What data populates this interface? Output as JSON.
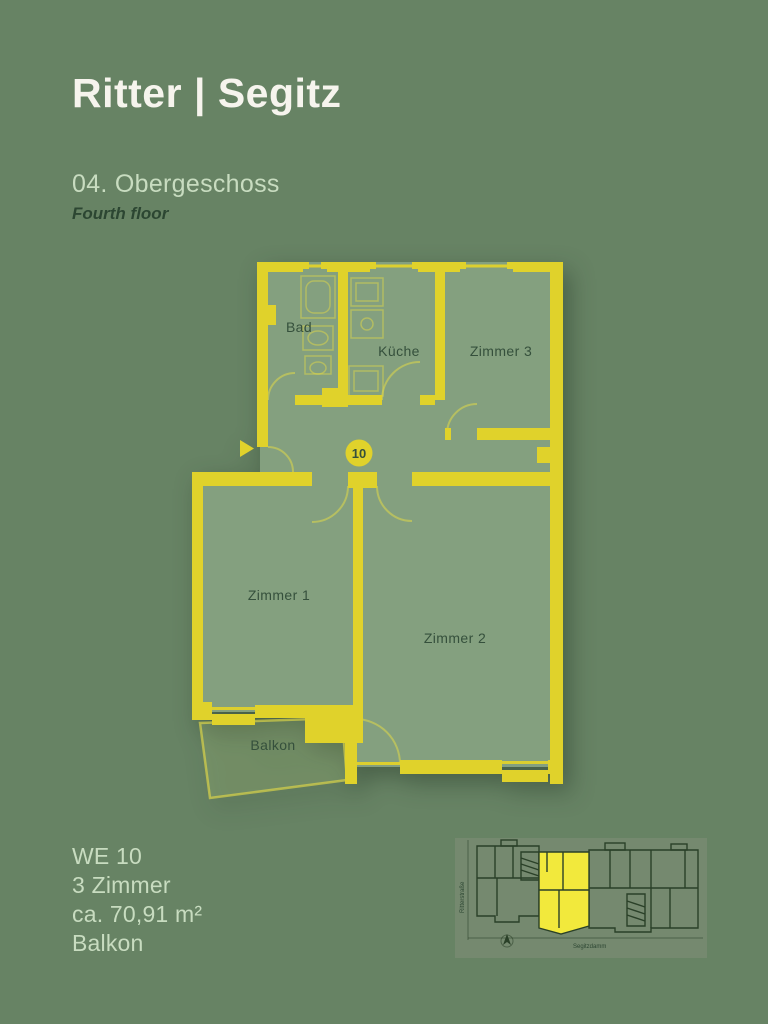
{
  "colors": {
    "bg": "#678364",
    "wall": "#E0D22B",
    "floor": "#84A07F",
    "label": "#35503C",
    "light_text": "#C8DCC0",
    "logo_text": "#F6F4ED",
    "dark_text": "#2C4632",
    "map_bg": "#75896F",
    "map_line": "#2A4028",
    "map_highlight": "#F2E93C"
  },
  "brand": {
    "logo": "Ritter | Segitz"
  },
  "header": {
    "title": "04. Obergeschoss",
    "subtitle": "Fourth floor"
  },
  "floorplan": {
    "badge": "10",
    "rooms": {
      "bad": "Bad",
      "kueche": "Küche",
      "zimmer3": "Zimmer 3",
      "zimmer1": "Zimmer 1",
      "zimmer2": "Zimmer 2",
      "balkon": "Balkon"
    }
  },
  "details": {
    "unit": "WE 10",
    "rooms": "3 Zimmer",
    "area": "ca. 70,91 m²",
    "extra": "Balkon"
  },
  "minimap": {
    "street_left": "Ritterstraße",
    "street_bottom": "Segitzdamm"
  }
}
